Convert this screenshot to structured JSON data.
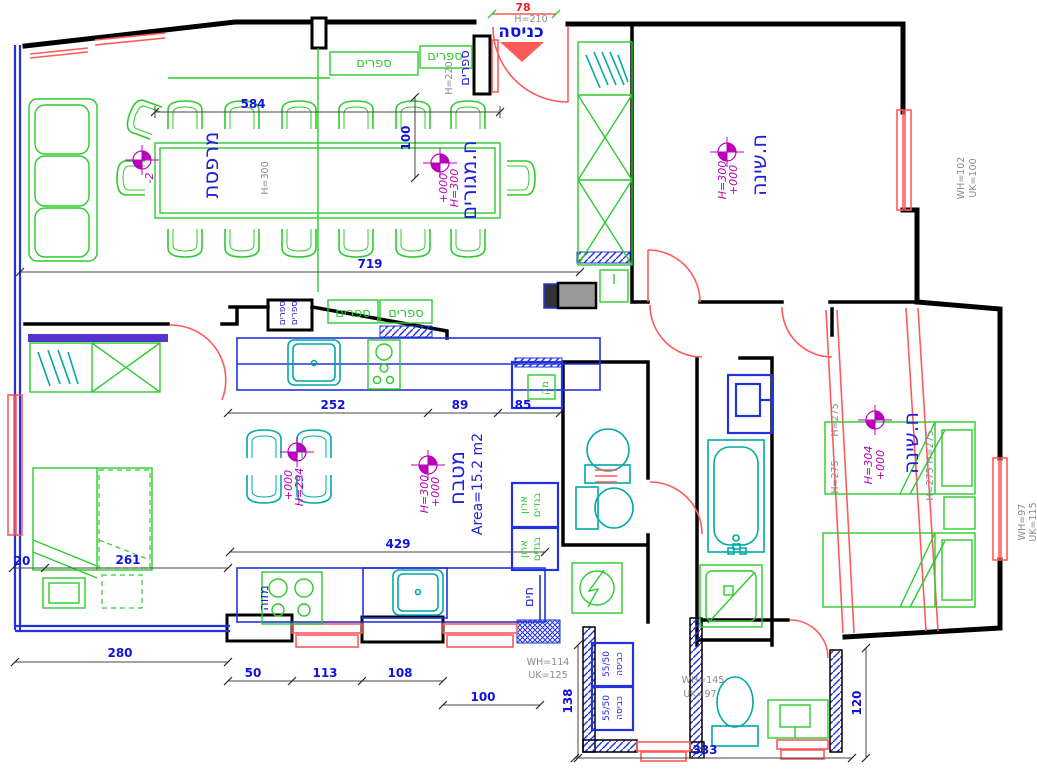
{
  "rooms": {
    "entrance": "כניסה",
    "balcony": "מרפסת",
    "living": "ח.מגורים",
    "bedroom": "ח.שינה",
    "kitchen": "מטבח",
    "kitchen_area": "Area=15.2 m2",
    "pantry": "מזוה",
    "fridge": "מק",
    "heater": "חים"
  },
  "shelves": {
    "books": "ספרים"
  },
  "closet": {
    "top": "ארון",
    "bottom": "בגדים"
  },
  "laundry": {
    "label": "כביסה",
    "size": "55/50"
  },
  "levels": {
    "zero": "+000",
    "minus2": "-2"
  },
  "heights": {
    "h300": "H=300",
    "h304": "H=304",
    "h294": "H=294",
    "h275": "H=275",
    "h210": "H=210",
    "h220": "H=220"
  },
  "notes": {
    "wh102": "WH=102",
    "uk100": "UK=100",
    "wh97": "WH=97",
    "uk115": "UK=115",
    "wh114": "WH=114",
    "uk125": "UK=125",
    "wh145": "WH=145",
    "uk97": "UK=97"
  },
  "dims": {
    "d78": "78",
    "d584": "584",
    "d100": "100",
    "d719": "719",
    "d252": "252",
    "d89": "89",
    "d85": "85",
    "d429": "429",
    "d20": "20",
    "d261": "261",
    "d280": "280",
    "d50": "50",
    "d113": "113",
    "d108": "108",
    "d100b": "100",
    "d138": "138",
    "d333": "333",
    "d120": "120"
  },
  "colors": {
    "wall": "#000000",
    "dimension": "#1212dd",
    "window_door": "#ff5a5a",
    "furniture": "#2ccc2c",
    "fixture": "#00a8a8",
    "level_mark": "#bb00bb",
    "annotation": "#8a8a8a",
    "low_wall": "#2233dd"
  }
}
